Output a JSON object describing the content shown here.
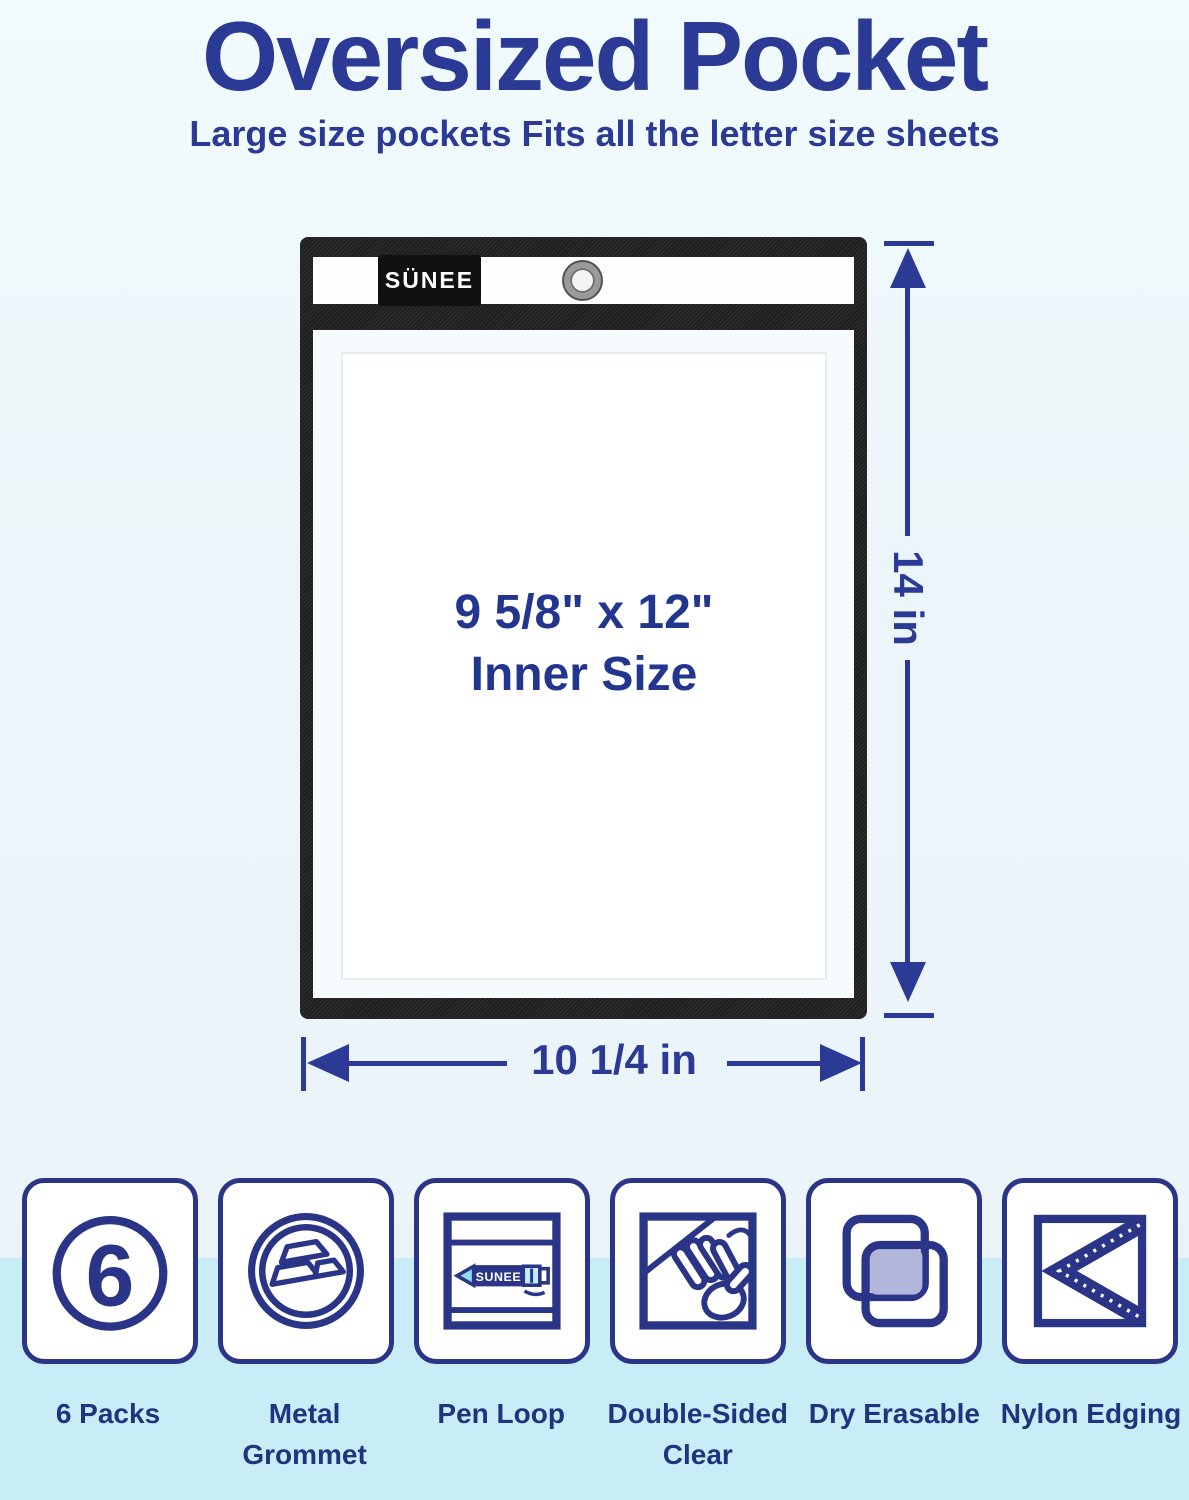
{
  "colors": {
    "navy_text": "#2b3a94",
    "icon_navy": "#2a3587",
    "edging_black": "#1f1f1f",
    "band_cyan": "#c8edf7",
    "lavender_fill": "#b1b6da",
    "pen_cyan": "#8fdeee",
    "background": "#eef6fa"
  },
  "header": {
    "title": "Oversized Pocket",
    "subtitle": "Large size pockets Fits all the letter size sheets"
  },
  "pocket": {
    "brand": "SÜNEE",
    "inner_size": "9 5/8\" x 12\"",
    "inner_size_caption": "Inner Size"
  },
  "dimensions": {
    "height": "14 in",
    "width": "10 1/4 in"
  },
  "features": [
    {
      "label": "6 Packs",
      "icon": "six-count-badge",
      "count": "6"
    },
    {
      "label": "Metal Grommet",
      "icon": "metal-grommet"
    },
    {
      "label": "Pen Loop",
      "icon": "pen-loop",
      "pen_brand": "SUNEE"
    },
    {
      "label": "Double-Sided Clear",
      "icon": "double-sided-clear"
    },
    {
      "label": "Dry Erasable",
      "icon": "dry-erasable"
    },
    {
      "label": "Nylon Edging",
      "icon": "nylon-edging"
    }
  ]
}
